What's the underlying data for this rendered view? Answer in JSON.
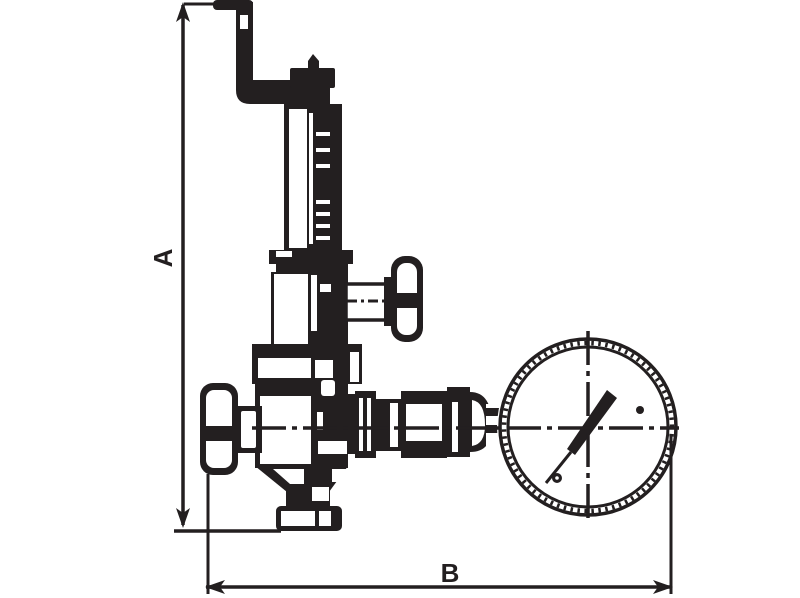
{
  "page": {
    "background_color": "#ffffff"
  },
  "drawing": {
    "type": "technical-line-drawing",
    "subject": "pressure reducing valve with pressure gauge",
    "ink_color": "#231f20",
    "highlight_color": "#ffffff",
    "dimension_a": {
      "label": "A",
      "orientation": "vertical"
    },
    "dimension_b": {
      "label": "B",
      "orientation": "horizontal"
    },
    "components": [
      "adjustment-crank-handle",
      "adjustment-screw-cap",
      "spring-bonnet",
      "bonnet-collar",
      "side-tee-handle",
      "body-top-flange",
      "valve-body",
      "inlet-knob",
      "bottom-outlet-flange",
      "union-fittings",
      "pressure-gauge",
      "gauge-needle",
      "center-lines"
    ]
  }
}
